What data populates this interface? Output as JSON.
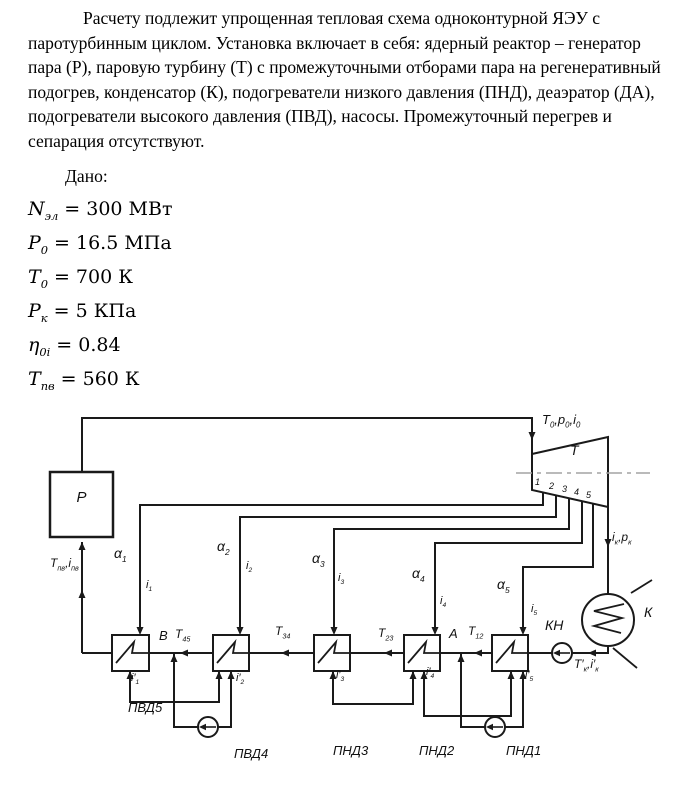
{
  "intro": "Расчету подлежит упрощенная тепловая схема одноконтурной ЯЭУ с паротурбинным циклом. Установка включает в себя: ядерный реактор – генератор пара (Р), паровую турбину (Т) с промежуточными отборами пара на регенеративный подогрев, конденсатор (К), подогреватели низкого давления (ПНД), деаэратор (ДА), подогреватели высокого давления (ПВД), насосы. Промежуточный перегрев и сепарация отсутствуют.",
  "given": {
    "title": "Дано:",
    "items": [
      {
        "v": "N_{эл}",
        "r": "= 300 МВт"
      },
      {
        "v": "P_{0}",
        "r": "= 16.5 МПа"
      },
      {
        "v": "T_{0}",
        "r": "= 700 К"
      },
      {
        "v": "P_{к}",
        "r": "= 5 КПа"
      },
      {
        "v": "η_{0i}",
        "r": "= 0.84"
      },
      {
        "v": "T_{пв}",
        "r": "= 560 К"
      }
    ]
  },
  "diagram": {
    "reactor_label": "Р",
    "turbine_label": "Т",
    "condenser_label": "К",
    "condensate_pump_label": "КН",
    "inlet_state": "T_{0},p_{0},i_{0}",
    "exhaust_state": "i_{к},p_{к}",
    "condensate_state": "T′_{к},i′_{к}",
    "feedwater_state": "T_{пв},i_{пв}",
    "extraction_numbers": [
      "1",
      "2",
      "3",
      "4",
      "5"
    ],
    "extraction_fractions": [
      "α_{1}",
      "α_{2}",
      "α_{3}",
      "α_{4}",
      "α_{5}"
    ],
    "extraction_enthalpies": [
      "i_{1}",
      "i_{2}",
      "i_{3}",
      "i_{4}",
      "i_{5}"
    ],
    "drain_enthalpies": [
      "i′_{1}",
      "i′_{2}",
      "i′_{3}",
      "i′_{4}",
      "i′_{5}"
    ],
    "mixing_points": [
      "В",
      "А"
    ],
    "interstage_temps": [
      "T_{45}",
      "T_{34}",
      "T_{23}",
      "T_{12}"
    ],
    "heater_labels": [
      "ПВД5",
      "ПВД4",
      "ПНД3",
      "ПНД2",
      "ПНД1"
    ]
  }
}
